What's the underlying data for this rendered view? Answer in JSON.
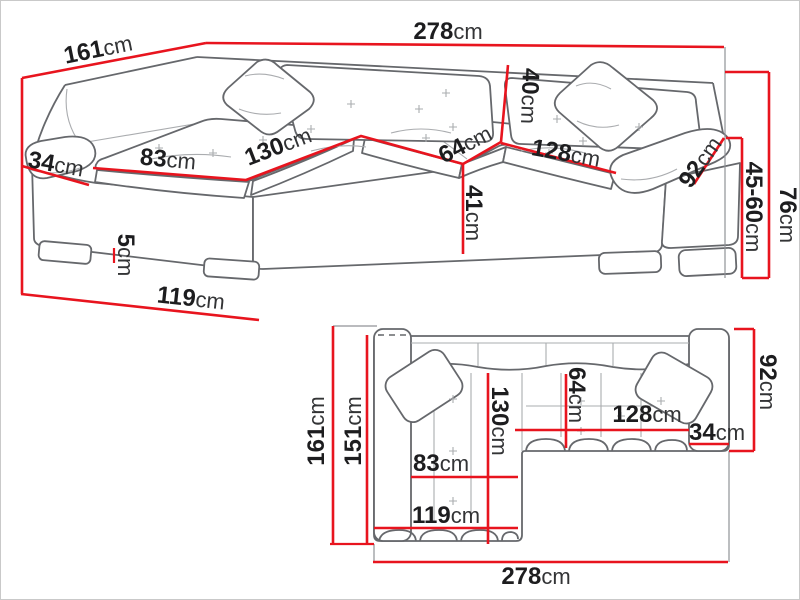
{
  "diagram": {
    "name": "Corner sofa dimension diagram",
    "unit": "cm"
  },
  "colors": {
    "dimension_red": "#e8141e",
    "outline_grey": "#66686c",
    "label_black": "#1d1d1f",
    "background": "#ffffff"
  },
  "perspective_view": {
    "name": "front perspective view",
    "dims": {
      "total_width": {
        "num": "278",
        "unit": "cm"
      },
      "back_depth": {
        "num": "161",
        "unit": "cm"
      },
      "armrest_front_width": {
        "num": "34",
        "unit": "cm"
      },
      "chaise_seat_width": {
        "num": "83",
        "unit": "cm"
      },
      "chaise_seat_length": {
        "num": "130",
        "unit": "cm"
      },
      "corner_seat_width": {
        "num": "64",
        "unit": "cm"
      },
      "backrest_cushion_height": {
        "num": "40",
        "unit": "cm"
      },
      "seat_front_height": {
        "num": "41",
        "unit": "cm"
      },
      "right_seat_length": {
        "num": "128",
        "unit": "cm"
      },
      "armrest_length": {
        "num": "92",
        "unit": "cm"
      },
      "total_height": {
        "num": "76",
        "unit": "cm"
      },
      "seat_height_range": {
        "num": "45-60",
        "unit": "cm"
      },
      "leg_height": {
        "num": "5",
        "unit": "cm"
      },
      "chaise_depth": {
        "num": "119",
        "unit": "cm"
      }
    }
  },
  "plan_view": {
    "name": "top plan view",
    "dims": {
      "total_depth": {
        "num": "161",
        "unit": "cm"
      },
      "inner_depth": {
        "num": "151",
        "unit": "cm"
      },
      "chaise_cushion_length": {
        "num": "130",
        "unit": "cm"
      },
      "corner_seat_width": {
        "num": "64",
        "unit": "cm"
      },
      "right_seat_length": {
        "num": "128",
        "unit": "cm"
      },
      "armrest_width": {
        "num": "34",
        "unit": "cm"
      },
      "body_depth": {
        "num": "92",
        "unit": "cm"
      },
      "chaise_seat_width": {
        "num": "83",
        "unit": "cm"
      },
      "chaise_total_width": {
        "num": "119",
        "unit": "cm"
      },
      "total_width": {
        "num": "278",
        "unit": "cm"
      }
    }
  }
}
